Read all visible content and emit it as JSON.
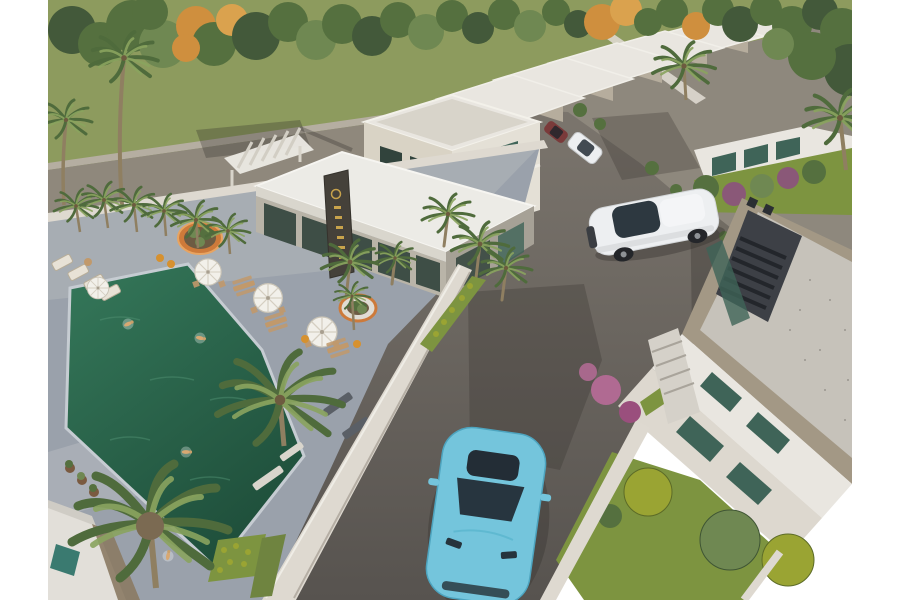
{
  "scene": {
    "type": "3d-architectural-render",
    "description": "Aerial 3D rendering of a villa resort: green swimming pool and paved sun deck with white umbrellas on the left, a white clubhouse with a dark sign pylon in the center, a row of white two-storey villas receding to the upper right, a modern gravel-roof villa in the lower right, asphalt roads with a white SUV and a turquoise sports car, dense green and orange trees along the top, white margins on both sides."
  },
  "palette": {
    "page_bg": "#ffffff",
    "grass": "#8d9b5e",
    "lawn": "#7d9440",
    "lawn_dark": "#6f8440",
    "tree_green": "#55703f",
    "tree_green_light": "#6f8852",
    "tree_green_dark": "#43593a",
    "tree_orange": "#cf8f3e",
    "tree_orange_light": "#daa24e",
    "road_upper": "#8f887c",
    "road_main_top": "#7b756d",
    "road_main_bottom": "#57534f",
    "driveway": "#8e887d",
    "sidewalk": "#b5aea1",
    "deck": "#9aa1ab",
    "deck_light": "#b7bcc2",
    "pool_top": "#35785a",
    "pool_bottom": "#1f4f3b",
    "pool_coping": "#c6ccd2",
    "wall_white": "#ded9d0",
    "wall_shadow": "#8d857a",
    "building_white": "#e9e6e0",
    "building_cream": "#d9d3c5",
    "building_shade": "#b6ad9d",
    "glass_dark": "#31433c",
    "glass_teal": "#3f6458",
    "sign_dark": "#45413a",
    "sign_gold": "#c8a34c",
    "roof_gravel": "#c6c2ba",
    "parapet_tan": "#a39885",
    "louver_dark": "#3d4046",
    "umbrella": "#f2f0ea",
    "furniture_tan": "#c1996b",
    "planter_orange": "#cd7a3a",
    "accent_orange": "#d6912f",
    "bush_yellow": "#9aa433",
    "bush_purple": "#8a5878",
    "flower_pink": "#b06a92",
    "palm_frond": "#4f6b3c",
    "palm_frond_light": "#8aa45f",
    "trunk": "#8f7f61",
    "car_white": "#edeff1",
    "car_cyan": "#74c5dc",
    "car_cyan_dark": "#4da4bf",
    "car_glass": "#232d36",
    "car_red": "#7a3a3a",
    "swimmer_skin": "#d8a872",
    "shadow": "#2e2b28"
  },
  "objects": {
    "pool": {
      "label": "swimming pool",
      "swimmers": 4
    },
    "pool_deck": {
      "label": "paved sun deck",
      "umbrellas": 4,
      "picnic_tables": 3
    },
    "clubhouse": {
      "label": "clubhouse with dark sign pylon and gold lettering"
    },
    "villa_row": {
      "label": "row of white two-storey villas",
      "count": 7
    },
    "right_villa": {
      "label": "modern flat-roof villa with gravel roof and louvre skylight"
    },
    "vehicles": [
      {
        "label": "white SUV driving on road"
      },
      {
        "label": "turquoise sports car driving toward viewer"
      },
      {
        "label": "parked white car in driveway"
      },
      {
        "label": "parked dark-red car in driveway"
      }
    ],
    "landscape": {
      "label": "palms, green shade trees with orange autumn accents, yellow and pink flower beds"
    }
  }
}
